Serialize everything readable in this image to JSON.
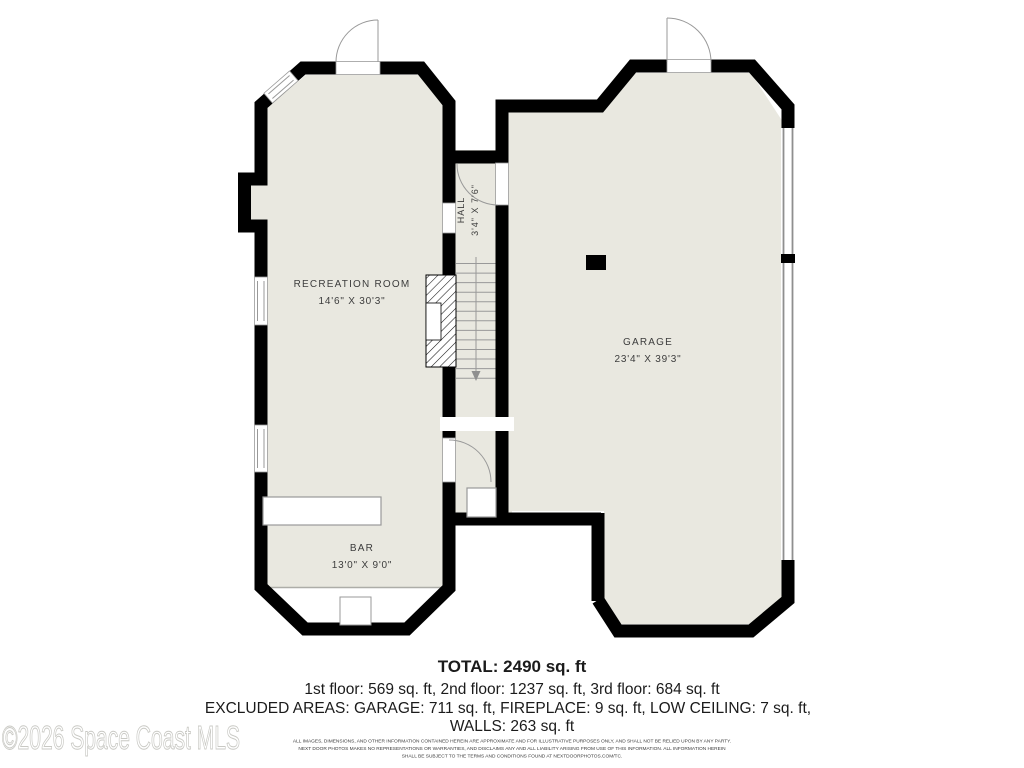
{
  "watermark": "©2026 Space Coast MLS",
  "rooms": {
    "recreation": {
      "name": "RECREATION ROOM",
      "dims": "14'6\" X 30'3\""
    },
    "bar": {
      "name": "BAR",
      "dims": "13'0\" X 9'0\""
    },
    "garage": {
      "name": "GARAGE",
      "dims": "23'4\" X 39'3\""
    },
    "hall": {
      "name": "HALL",
      "dims": "3'4\" X 7'6\""
    }
  },
  "summary": {
    "total": "TOTAL: 2490 sq. ft",
    "floors": "1st floor: 569 sq. ft, 2nd floor: 1237 sq. ft, 3rd floor: 684 sq. ft",
    "excluded_line1": "EXCLUDED AREAS: GARAGE: 711 sq. ft, FIREPLACE: 9 sq. ft, LOW CEILING: 7 sq. ft,",
    "excluded_line2": "WALLS: 263 sq. ft"
  },
  "disclaimer": {
    "line1": "ALL IMAGES, DIMENSIONS, AND OTHER INFORMATION CONTAINED HEREIN ARE APPROXIMATE AND FOR ILLUSTRATIVE PURPOSES ONLY, AND SHALL NOT BE RELIED UPON BY ANY PARTY.",
    "line2": "NEXT DOOR PHOTOS MAKES NO REPRESENTATIONS OR WARRANTIES, AND DISCLAIMS ANY AND ALL LIABILITY ARISING FROM USE OF THIS INFORMATION. ALL INFORMATION HEREIN",
    "line3": "SHALL BE SUBJECT TO THE TERMS AND CONDITIONS FOUND AT NEXTDOORPHOTOS.COM/TC."
  },
  "colors": {
    "floor": "#e9e8e0",
    "wall": "#000000",
    "detail_gray": "#999999",
    "watermark_gray": "#c9c9c4"
  }
}
